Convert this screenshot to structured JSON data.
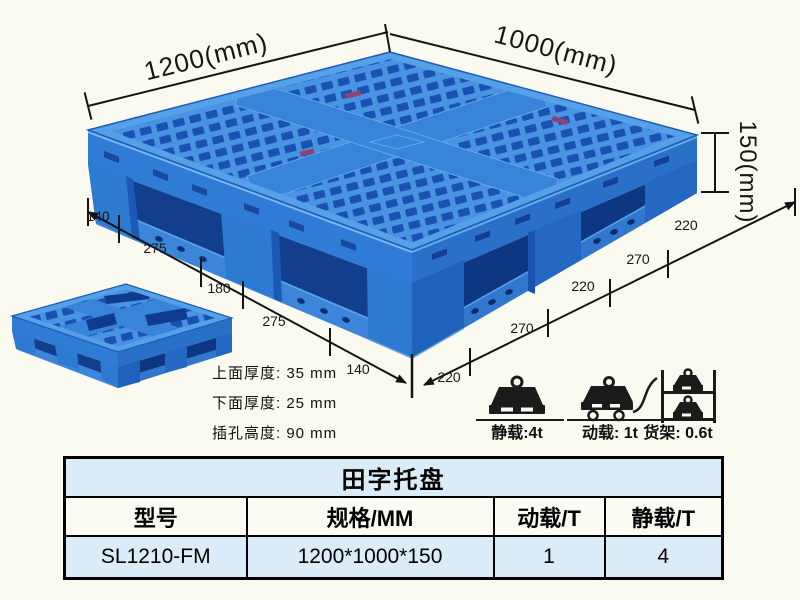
{
  "colors": {
    "background": "#fbfaf1",
    "pallet_blue": "#2e7cd6",
    "pallet_dark_blue": "#123e8c",
    "pallet_light_blue": "#55a0e6",
    "table_row_blue": "#d9ecf7",
    "ink": "#141414"
  },
  "main_pallet": {
    "dim_length": "1200(mm)",
    "dim_width": "1000(mm)",
    "dim_height": "150(mm)",
    "front_left_segments": [
      "140",
      "275",
      "180",
      "275",
      "140"
    ],
    "front_right_segments": [
      "220",
      "270",
      "220",
      "270",
      "220"
    ]
  },
  "thickness_notes": {
    "top": "上面厚度: 35 mm",
    "bottom": "下面厚度: 25 mm",
    "fork": "插孔高度: 90 mm"
  },
  "load_ratings": {
    "static": "静载:4t",
    "dynamic": "动载: 1t",
    "rack": "货架: 0.6t"
  },
  "spec_table": {
    "title": "田字托盘",
    "headers": [
      "型号",
      "规格/MM",
      "动载/T",
      "静载/T"
    ],
    "row": [
      "SL1210-FM",
      "1200*1000*150",
      "1",
      "4"
    ]
  }
}
